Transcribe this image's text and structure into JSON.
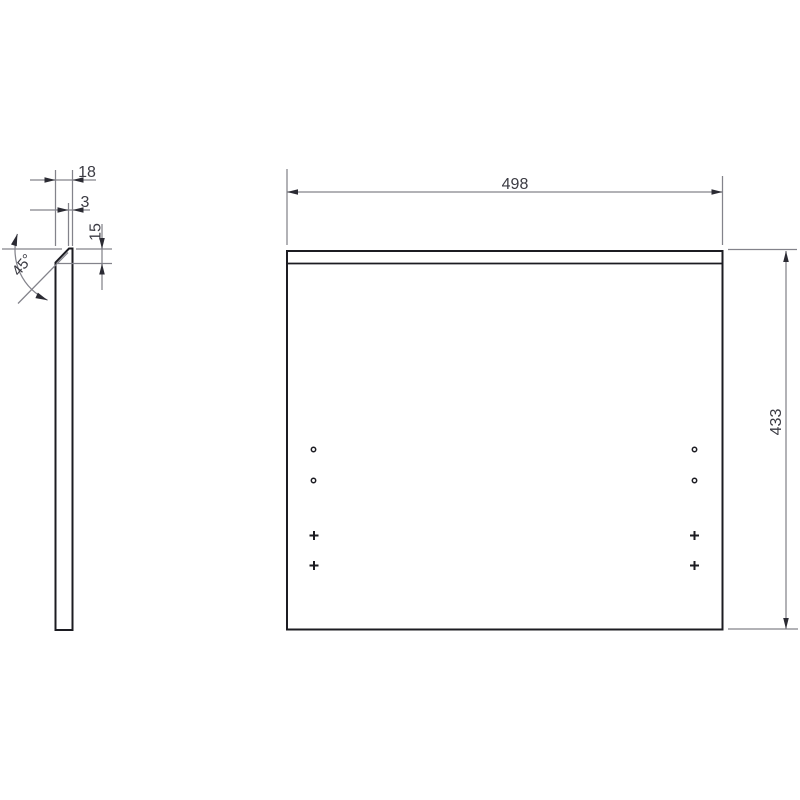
{
  "drawing": {
    "side_view": {
      "dim_thickness": "18",
      "dim_top_flat": "3",
      "dim_chamfer_height": "15",
      "dim_chamfer_angle": "45°"
    },
    "front_view": {
      "dim_width": "498",
      "dim_height": "433"
    },
    "colors": {
      "background": "#ffffff",
      "object_line": "#1c1c22",
      "dimension_line": "#83838b",
      "arrowhead": "#2b2b33",
      "text": "#3b3b43"
    }
  }
}
